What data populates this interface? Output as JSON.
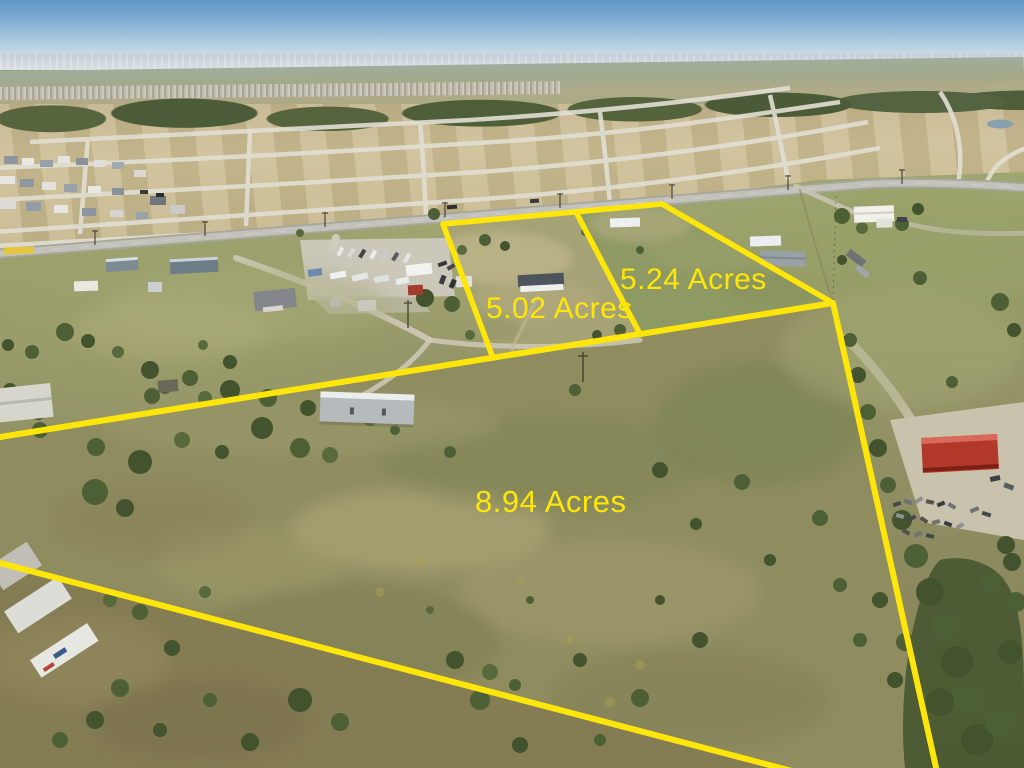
{
  "image": {
    "type": "aerial-drone-photo",
    "description": "Aerial view of rural acreage for sale with surveyed parcel boundaries outlined in yellow; new home subdivision, graded lots and highway in background",
    "overlay_color": "#ffe60a"
  },
  "parcels": [
    {
      "name": "parcel-1",
      "label": "5.02 Acres"
    },
    {
      "name": "parcel-2",
      "label": "5.24 Acres"
    },
    {
      "name": "parcel-3",
      "label": "8.94 Acres"
    }
  ]
}
